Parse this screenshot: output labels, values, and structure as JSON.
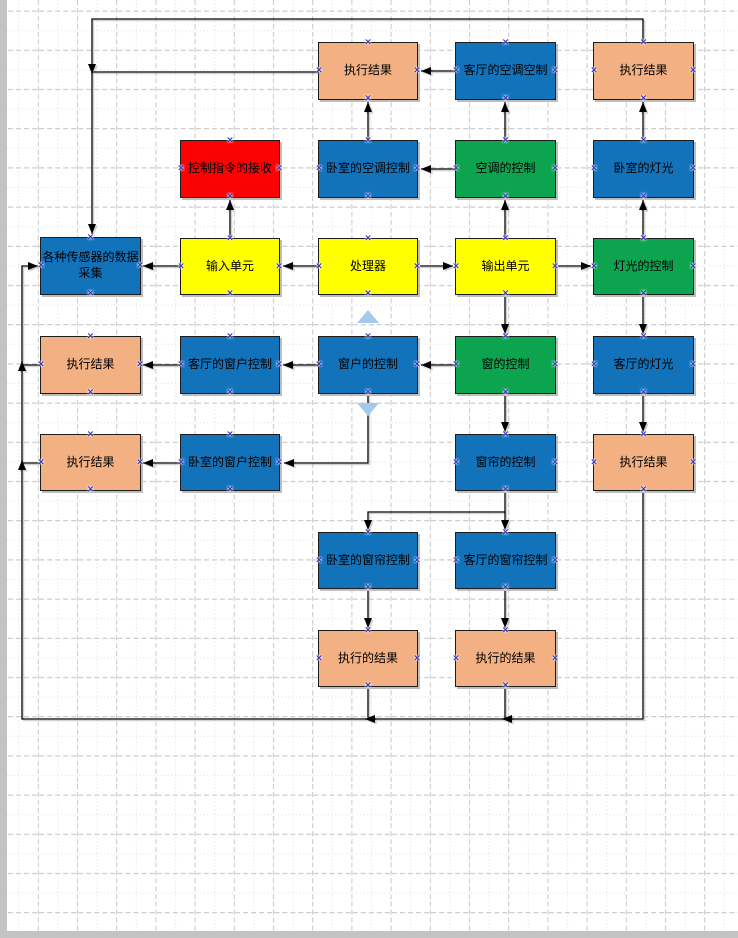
{
  "page": {
    "width": 738,
    "height": 938,
    "background": "#ffffff",
    "grid_light": "#e4e4e4",
    "grid_dark": "#c7c7c7",
    "page_edge": "#c3c3c3"
  },
  "palette": {
    "orange": "#f2b083",
    "blue": "#1273bb",
    "green": "#0da450",
    "red": "#fb0204",
    "yellow": "#ffff00",
    "connector": "#000000",
    "connector_shadow": "#9c9c9c",
    "connection_point": "#2e2eb8",
    "autoconnect_arrow": "#a5c9ea"
  },
  "connection_point_glyph": "×",
  "nodes": [
    {
      "id": "exec-result-ac-bedroom",
      "label": "执行结果",
      "color": "orange",
      "x": 318,
      "y": 42,
      "w": 100,
      "h": 58
    },
    {
      "id": "living-room-ac-control",
      "label": "客厅的空调空制",
      "color": "blue",
      "x": 455,
      "y": 42,
      "w": 101,
      "h": 58
    },
    {
      "id": "exec-result-light-bedroom",
      "label": "执行结果",
      "color": "orange",
      "x": 593,
      "y": 42,
      "w": 101,
      "h": 58
    },
    {
      "id": "command-receiving",
      "label": "控制指令的接收",
      "color": "red",
      "x": 180,
      "y": 140,
      "w": 100,
      "h": 58
    },
    {
      "id": "bedroom-ac-control",
      "label": "卧室的空调控制",
      "color": "blue",
      "x": 318,
      "y": 140,
      "w": 100,
      "h": 58
    },
    {
      "id": "ac-control",
      "label": "空调的控制",
      "color": "green",
      "x": 455,
      "y": 140,
      "w": 101,
      "h": 58
    },
    {
      "id": "bedroom-light",
      "label": "卧室的灯光",
      "color": "blue",
      "x": 593,
      "y": 140,
      "w": 101,
      "h": 58
    },
    {
      "id": "sensor-data-collection",
      "label": "各种传感器的数据\n采集",
      "color": "blue",
      "x": 40,
      "y": 237,
      "w": 101,
      "h": 58
    },
    {
      "id": "input-unit",
      "label": "输入单元",
      "color": "yellow",
      "x": 180,
      "y": 238,
      "w": 100,
      "h": 57
    },
    {
      "id": "processor",
      "label": "处理器",
      "color": "yellow",
      "x": 318,
      "y": 238,
      "w": 100,
      "h": 57
    },
    {
      "id": "output-unit",
      "label": "输出单元",
      "color": "yellow",
      "x": 455,
      "y": 238,
      "w": 101,
      "h": 57
    },
    {
      "id": "light-control",
      "label": "灯光的控制",
      "color": "green",
      "x": 593,
      "y": 238,
      "w": 101,
      "h": 57
    },
    {
      "id": "exec-result-window-living",
      "label": "执行结果",
      "color": "orange",
      "x": 40,
      "y": 336,
      "w": 101,
      "h": 58
    },
    {
      "id": "living-window-control",
      "label": "客厅的窗户控制",
      "color": "blue",
      "x": 180,
      "y": 336,
      "w": 100,
      "h": 58
    },
    {
      "id": "window-control",
      "label": "窗户的控制",
      "color": "blue",
      "x": 318,
      "y": 336,
      "w": 100,
      "h": 58
    },
    {
      "id": "window-ctrl",
      "label": "窗的控制",
      "color": "green",
      "x": 455,
      "y": 336,
      "w": 101,
      "h": 58
    },
    {
      "id": "living-light",
      "label": "客厅的灯光",
      "color": "blue",
      "x": 593,
      "y": 336,
      "w": 101,
      "h": 58
    },
    {
      "id": "exec-result-window-bedroom",
      "label": "执行结果",
      "color": "orange",
      "x": 40,
      "y": 434,
      "w": 101,
      "h": 57
    },
    {
      "id": "bedroom-window-control",
      "label": "卧室的窗户控制",
      "color": "blue",
      "x": 180,
      "y": 434,
      "w": 100,
      "h": 57
    },
    {
      "id": "curtain-control",
      "label": "窗帘的控制",
      "color": "blue",
      "x": 455,
      "y": 434,
      "w": 101,
      "h": 57
    },
    {
      "id": "exec-result-curtain",
      "label": "执行结果",
      "color": "orange",
      "x": 593,
      "y": 434,
      "w": 101,
      "h": 57
    },
    {
      "id": "bedroom-curtain-control",
      "label": "卧室的窗帘控制",
      "color": "blue",
      "x": 318,
      "y": 532,
      "w": 100,
      "h": 57
    },
    {
      "id": "living-curtain-control",
      "label": "客厅的窗帘控制",
      "color": "blue",
      "x": 455,
      "y": 532,
      "w": 101,
      "h": 57
    },
    {
      "id": "exec-result-bedroom-curtain",
      "label": "执行的结果",
      "color": "orange",
      "x": 318,
      "y": 630,
      "w": 100,
      "h": 57
    },
    {
      "id": "exec-result-living-curtain",
      "label": "执行的结果",
      "color": "orange",
      "x": 455,
      "y": 630,
      "w": 101,
      "h": 57
    }
  ],
  "connectors": [
    {
      "points": [
        [
          318,
          72
        ],
        [
          92,
          72
        ],
        [
          92,
          234
        ]
      ],
      "arrow": true
    },
    {
      "points": [
        [
          643,
          42
        ],
        [
          643,
          19
        ],
        [
          92,
          19
        ],
        [
          92,
          74
        ]
      ],
      "arrow": true
    },
    {
      "points": [
        [
          455,
          71
        ],
        [
          421,
          71
        ]
      ],
      "arrow": true
    },
    {
      "points": [
        [
          455,
          169
        ],
        [
          421,
          169
        ]
      ],
      "arrow": true
    },
    {
      "points": [
        [
          368,
          140
        ],
        [
          368,
          102
        ]
      ],
      "arrow": true
    },
    {
      "points": [
        [
          505,
          140
        ],
        [
          505,
          102
        ]
      ],
      "arrow": true
    },
    {
      "points": [
        [
          643,
          140
        ],
        [
          643,
          102
        ]
      ],
      "arrow": true
    },
    {
      "points": [
        [
          230,
          238
        ],
        [
          230,
          200
        ]
      ],
      "arrow": true
    },
    {
      "points": [
        [
          505,
          238
        ],
        [
          505,
          200
        ]
      ],
      "arrow": true
    },
    {
      "points": [
        [
          643,
          238
        ],
        [
          643,
          200
        ]
      ],
      "arrow": true
    },
    {
      "points": [
        [
          180,
          266
        ],
        [
          143,
          266
        ]
      ],
      "arrow": true
    },
    {
      "points": [
        [
          318,
          266
        ],
        [
          283,
          266
        ]
      ],
      "arrow": true
    },
    {
      "points": [
        [
          418,
          266
        ],
        [
          453,
          266
        ]
      ],
      "arrow": true
    },
    {
      "points": [
        [
          556,
          266
        ],
        [
          591,
          266
        ]
      ],
      "arrow": true
    },
    {
      "points": [
        [
          180,
          365
        ],
        [
          143,
          365
        ]
      ],
      "arrow": true
    },
    {
      "points": [
        [
          318,
          365
        ],
        [
          283,
          365
        ]
      ],
      "arrow": true
    },
    {
      "points": [
        [
          455,
          365
        ],
        [
          421,
          365
        ]
      ],
      "arrow": true
    },
    {
      "points": [
        [
          505,
          295
        ],
        [
          505,
          334
        ]
      ],
      "arrow": true
    },
    {
      "points": [
        [
          643,
          295
        ],
        [
          643,
          334
        ]
      ],
      "arrow": true
    },
    {
      "points": [
        [
          368,
          394
        ],
        [
          368,
          463
        ],
        [
          284,
          463
        ]
      ],
      "arrow": true
    },
    {
      "points": [
        [
          180,
          463
        ],
        [
          143,
          463
        ]
      ],
      "arrow": true
    },
    {
      "points": [
        [
          505,
          394
        ],
        [
          505,
          432
        ]
      ],
      "arrow": true
    },
    {
      "points": [
        [
          643,
          394
        ],
        [
          643,
          432
        ]
      ],
      "arrow": true
    },
    {
      "points": [
        [
          505,
          491
        ],
        [
          505,
          512
        ],
        [
          368,
          512
        ],
        [
          368,
          530
        ]
      ],
      "arrow": true
    },
    {
      "points": [
        [
          505,
          512
        ],
        [
          505,
          530
        ]
      ],
      "arrow": true
    },
    {
      "points": [
        [
          368,
          589
        ],
        [
          368,
          628
        ]
      ],
      "arrow": true
    },
    {
      "points": [
        [
          505,
          589
        ],
        [
          505,
          628
        ]
      ],
      "arrow": true
    },
    {
      "points": [
        [
          368,
          687
        ],
        [
          368,
          719
        ]
      ],
      "arrow": false
    },
    {
      "points": [
        [
          505,
          687
        ],
        [
          505,
          719
        ]
      ],
      "arrow": false
    },
    {
      "points": [
        [
          643,
          491
        ],
        [
          643,
          719
        ],
        [
          22,
          719
        ],
        [
          22,
          266
        ],
        [
          38,
          266
        ]
      ],
      "arrow": true
    },
    {
      "points": [
        [
          40,
          365
        ],
        [
          22,
          365
        ]
      ],
      "arrow": false
    },
    {
      "points": [
        [
          40,
          463
        ],
        [
          22,
          463
        ]
      ],
      "arrow": false
    },
    {
      "points": [
        [
          376,
          719
        ],
        [
          365,
          719
        ]
      ],
      "arrow": true
    },
    {
      "points": [
        [
          513,
          719
        ],
        [
          502,
          719
        ]
      ],
      "arrow": true
    },
    {
      "points": [
        [
          22,
          371
        ],
        [
          22,
          361
        ]
      ],
      "arrow": true
    },
    {
      "points": [
        [
          22,
          470
        ],
        [
          22,
          460
        ]
      ],
      "arrow": true
    }
  ],
  "autoconnect_arrows": [
    {
      "direction": "up",
      "x": 368,
      "y": 317
    },
    {
      "direction": "down",
      "x": 368,
      "y": 409
    }
  ]
}
